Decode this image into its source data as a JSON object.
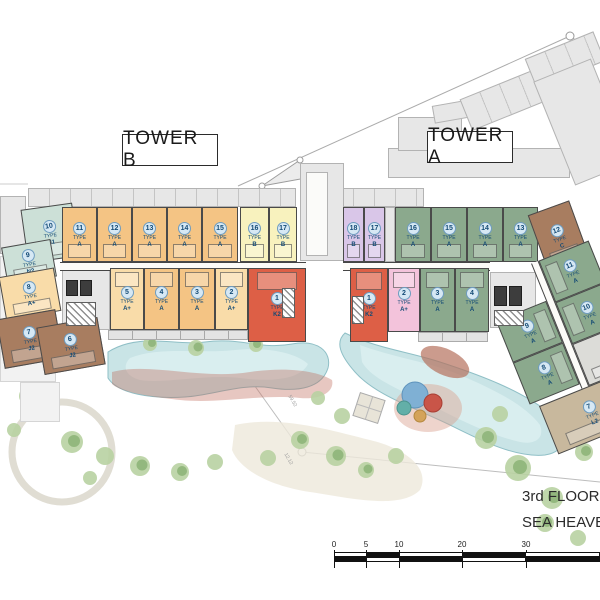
{
  "labels": {
    "type": "TYPE"
  },
  "palette": {
    "type_a_tower_b": "#F4C484",
    "type_a_plus": "#F9DCA9",
    "type_b_tower_b": "#F8F2BE",
    "type_b_tower_a": "#D9C6E8",
    "type_a_plus_pink": "#F3C3DB",
    "type_a_tower_a": "#8BA98D",
    "type_c_j2": "#A87D60",
    "type_l2": "#C8B89D",
    "type_k2": "#DD5F46",
    "type_n1_n2": "#CCE0D7",
    "pool": "#C9E4E6",
    "ghost": "#E7E7E7"
  },
  "tower_b": {
    "label": "TOWER B",
    "top_row": [
      {
        "num": "10",
        "type": "N1"
      },
      {
        "num": "11",
        "type": "A"
      },
      {
        "num": "12",
        "type": "A"
      },
      {
        "num": "13",
        "type": "A"
      },
      {
        "num": "14",
        "type": "A"
      },
      {
        "num": "15",
        "type": "A"
      },
      {
        "num": "16",
        "type": "B"
      },
      {
        "num": "17",
        "type": "B"
      }
    ],
    "bottom_row": [
      {
        "num": "5",
        "type": "A+"
      },
      {
        "num": "4",
        "type": "A"
      },
      {
        "num": "3",
        "type": "A"
      },
      {
        "num": "2",
        "type": "A+"
      },
      {
        "num": "1",
        "type": "K2"
      }
    ],
    "left_wing": [
      {
        "num": "9",
        "type": "N2"
      },
      {
        "num": "8",
        "type": "A+"
      },
      {
        "num": "7",
        "type": "J2"
      },
      {
        "num": "6",
        "type": "J2"
      }
    ]
  },
  "tower_a": {
    "label": "TOWER A",
    "top_row": [
      {
        "num": "18",
        "type": "B"
      },
      {
        "num": "17",
        "type": "B"
      },
      {
        "num": "16",
        "type": "A"
      },
      {
        "num": "15",
        "type": "A"
      },
      {
        "num": "14",
        "type": "A"
      },
      {
        "num": "13",
        "type": "A"
      },
      {
        "num": "12",
        "type": "C"
      }
    ],
    "bottom_row": [
      {
        "num": "1",
        "type": "K2"
      },
      {
        "num": "2",
        "type": "A+"
      },
      {
        "num": "3",
        "type": "A"
      },
      {
        "num": "4",
        "type": "A"
      }
    ],
    "right_wing": [
      {
        "num": "11",
        "type": "A"
      },
      {
        "num": "10",
        "type": "A"
      },
      {
        "num": "9",
        "type": "A"
      },
      {
        "num": "8",
        "type": "A"
      },
      {
        "num": "7",
        "type": "L2"
      }
    ]
  },
  "title": {
    "line1": "3rd FLOOR P",
    "line2": "SEA HEAVE"
  },
  "scale_bar": {
    "ticks": [
      "0",
      "5",
      "10",
      "20",
      "30"
    ]
  },
  "survey_marks": [
    "59.52",
    "12.12"
  ]
}
